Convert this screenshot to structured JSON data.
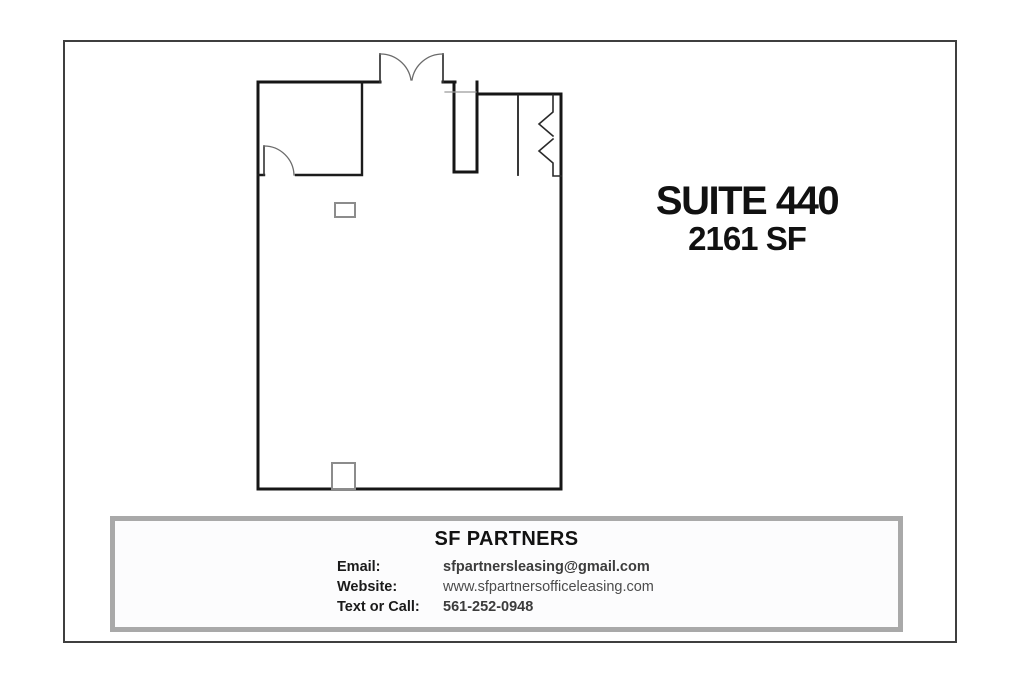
{
  "title_block": {
    "suite": "SUITE 440",
    "area": "2161 SF"
  },
  "contact_card": {
    "company": "SF PARTNERS",
    "rows": [
      {
        "label": "Email:",
        "value": "sfpartnersleasing@gmail.com"
      },
      {
        "label": "Website:",
        "value": "www.sfpartnersofficeleasing.com"
      },
      {
        "label": "Text or Call:",
        "value": "561-252-0948"
      }
    ]
  },
  "colors": {
    "wall": "#161616",
    "frame_border": "#3f3f3f",
    "card_border": "#a9a9a9",
    "title_text": "#111111",
    "value_text": "#3c3c3c"
  }
}
